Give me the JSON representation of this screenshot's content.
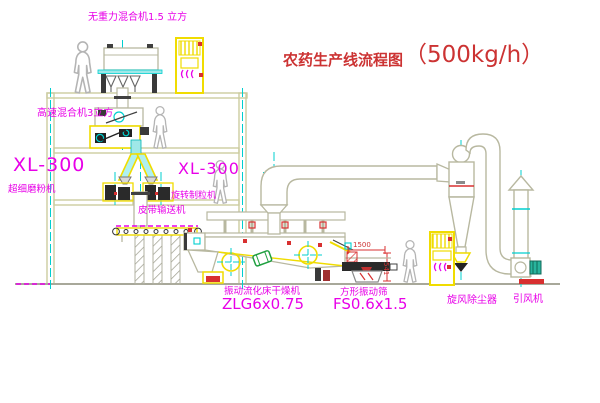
{
  "title": {
    "cn": "农药生产线流程图",
    "capacity": "（500kg/h）"
  },
  "labels": {
    "gravity_mixer": "无重力混合机1.5 立方",
    "high_speed_mixer": "高速混合机3立方",
    "mill_model": "XL-300",
    "mill_name": "超细磨粉机",
    "granulator_model": "XL-300",
    "granulator_name": "旋转制粒机",
    "belt_conveyor": "皮带输送机",
    "dryer_name": "振动流化床干燥机",
    "dryer_model": "ZLG6x0.75",
    "screen_name": "方形振动筛",
    "screen_model": "FS0.6x1.5",
    "cyclone": "旋风除尘器",
    "fan": "引风机"
  },
  "dimensions": {
    "screen_length": "1500",
    "screen_height": "541"
  },
  "colors": {
    "label_magenta": "#e800e8",
    "title_red": "#cc3333",
    "cad_yellow": "#f0dc00",
    "centerline_cyan": "#00cfcf",
    "structure_pale": "#ccccA0",
    "accent_red": "#d83030",
    "drum_green": "#20a040"
  },
  "diagram_type": "CAD production line flow diagram"
}
